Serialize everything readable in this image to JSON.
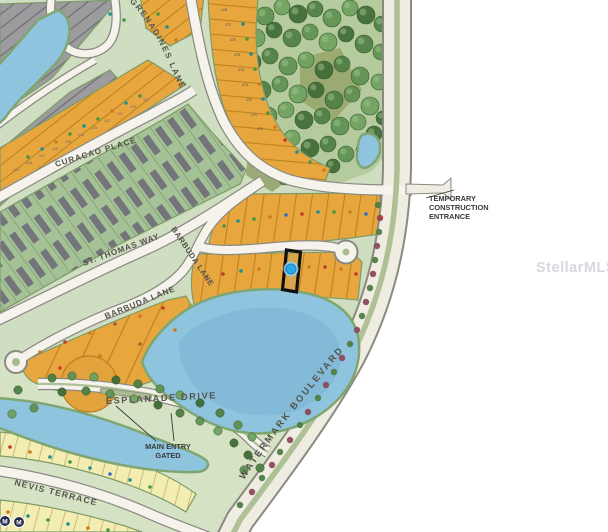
{
  "overlay": {
    "mls_watermark": "StellarMLS"
  },
  "streets": {
    "grenadines": "GRENADINES LANE",
    "curacao": "CURACAO PLACE",
    "st_thomas": "ST. THOMAS WAY",
    "barbuda_upper": "BARBUDA LANE",
    "barbuda_lower": "BARBUDA LANE",
    "esplanade": "ESPLANADE DRIVE",
    "nevis": "NEVIS TERRACE",
    "watermark_blvd": "WATERMARK BOULEVARD"
  },
  "annotations": {
    "temp_entrance": [
      "TEMPORARY",
      "CONSTRUCTION",
      "ENTRANCE"
    ],
    "main_entry": [
      "MAIN ENTRY",
      "GATED"
    ],
    "badge": "M"
  },
  "colors": {
    "base_green": "#cfdec0",
    "forest_green": "#b5cb9e",
    "pond_blue": "#8fc4de",
    "pond_deep": "#79b2d2",
    "road_fill": "#f5f3ec",
    "road_casing": "#8a8a82",
    "blvd_fill": "#efece1",
    "median_green": "#adc096",
    "lot_orange": "#e7a73e",
    "lot_yellow": "#f3edb2",
    "lot_gray": "#9c9c9e",
    "highlight_outline": "#101010",
    "subject_marker": "#2aa7e8",
    "subject_marker_ring": "#8fd0f0"
  },
  "map": {
    "tree_colors": [
      "#3f6b36",
      "#4f7f44",
      "#5f9252",
      "#6fa261"
    ],
    "shrub_colors": {
      "g": "#4e7c42",
      "r": "#8d4a5c"
    },
    "marker_colors": {
      "T": "#1d8f8f",
      "G": "#44973c",
      "O": "#d0791c",
      "R": "#c03a2c",
      "B": "#2f6fc2",
      "N": "#9a6a2a",
      "Y": "#8a7468",
      "K": "#6b6156"
    },
    "trees": [
      [
        230,
        12,
        9
      ],
      [
        248,
        8,
        8
      ],
      [
        265,
        16,
        9
      ],
      [
        282,
        7,
        8
      ],
      [
        298,
        14,
        9
      ],
      [
        315,
        9,
        8
      ],
      [
        332,
        18,
        9
      ],
      [
        350,
        8,
        8
      ],
      [
        366,
        15,
        9
      ],
      [
        382,
        24,
        8
      ],
      [
        238,
        32,
        8
      ],
      [
        256,
        38,
        9
      ],
      [
        274,
        30,
        8
      ],
      [
        292,
        38,
        9
      ],
      [
        310,
        32,
        8
      ],
      [
        328,
        42,
        9
      ],
      [
        346,
        34,
        8
      ],
      [
        364,
        44,
        9
      ],
      [
        381,
        52,
        8
      ],
      [
        234,
        56,
        8
      ],
      [
        252,
        62,
        9
      ],
      [
        270,
        56,
        8
      ],
      [
        288,
        66,
        9
      ],
      [
        306,
        60,
        8
      ],
      [
        324,
        70,
        9
      ],
      [
        342,
        64,
        8
      ],
      [
        360,
        76,
        9
      ],
      [
        379,
        82,
        8
      ],
      [
        244,
        84,
        8
      ],
      [
        262,
        90,
        9
      ],
      [
        280,
        84,
        8
      ],
      [
        298,
        94,
        9
      ],
      [
        316,
        90,
        8
      ],
      [
        334,
        100,
        9
      ],
      [
        352,
        94,
        8
      ],
      [
        370,
        106,
        9
      ],
      [
        383,
        118,
        7
      ],
      [
        250,
        110,
        8
      ],
      [
        268,
        116,
        9
      ],
      [
        286,
        110,
        8
      ],
      [
        304,
        120,
        9
      ],
      [
        322,
        116,
        8
      ],
      [
        340,
        126,
        9
      ],
      [
        358,
        122,
        8
      ],
      [
        374,
        134,
        8
      ],
      [
        256,
        136,
        8
      ],
      [
        274,
        142,
        9
      ],
      [
        292,
        138,
        8
      ],
      [
        310,
        148,
        9
      ],
      [
        328,
        144,
        8
      ],
      [
        346,
        154,
        8
      ],
      [
        363,
        150,
        7
      ],
      [
        262,
        160,
        8
      ],
      [
        280,
        166,
        8
      ],
      [
        298,
        162,
        7
      ],
      [
        316,
        170,
        8
      ],
      [
        333,
        166,
        7
      ],
      [
        285,
        178,
        7
      ]
    ],
    "esplanade_trees": [
      [
        52,
        378
      ],
      [
        72,
        376
      ],
      [
        94,
        377
      ],
      [
        116,
        380
      ],
      [
        138,
        384
      ],
      [
        160,
        389
      ],
      [
        180,
        395
      ],
      [
        200,
        403
      ],
      [
        220,
        413
      ],
      [
        238,
        425
      ],
      [
        252,
        437
      ],
      [
        62,
        392
      ],
      [
        86,
        391
      ],
      [
        110,
        394
      ],
      [
        134,
        399
      ],
      [
        158,
        405
      ],
      [
        180,
        413
      ],
      [
        200,
        421
      ],
      [
        218,
        431
      ],
      [
        234,
        443
      ],
      [
        18,
        390
      ],
      [
        34,
        408
      ],
      [
        12,
        414
      ],
      [
        248,
        455
      ],
      [
        260,
        468
      ],
      [
        244,
        470
      ]
    ],
    "shrubs": [
      [
        240,
        505,
        "g"
      ],
      [
        252,
        492,
        "r"
      ],
      [
        262,
        478,
        "g"
      ],
      [
        272,
        465,
        "r"
      ],
      [
        280,
        452,
        "g"
      ],
      [
        290,
        440,
        "r"
      ],
      [
        300,
        425,
        "g"
      ],
      [
        308,
        412,
        "r"
      ],
      [
        318,
        398,
        "g"
      ],
      [
        326,
        385,
        "r"
      ],
      [
        334,
        372,
        "g"
      ],
      [
        342,
        358,
        "r"
      ],
      [
        350,
        344,
        "g"
      ],
      [
        357,
        330,
        "r"
      ],
      [
        362,
        316,
        "g"
      ],
      [
        366,
        302,
        "r"
      ],
      [
        370,
        288,
        "g"
      ],
      [
        373,
        274,
        "r"
      ],
      [
        375,
        260,
        "g"
      ],
      [
        377,
        246,
        "r"
      ],
      [
        379,
        232,
        "g"
      ],
      [
        380,
        218,
        "r"
      ],
      [
        378,
        205,
        "g"
      ]
    ],
    "lot_markers": [
      {
        "x": 28,
        "y": 157,
        "c": "G"
      },
      {
        "x": 42,
        "y": 149,
        "c": "T"
      },
      {
        "x": 56,
        "y": 142,
        "c": "O"
      },
      {
        "x": 70,
        "y": 134,
        "c": "G"
      },
      {
        "x": 84,
        "y": 126,
        "c": "T"
      },
      {
        "x": 98,
        "y": 119,
        "c": "G"
      },
      {
        "x": 112,
        "y": 111,
        "c": "O"
      },
      {
        "x": 126,
        "y": 103,
        "c": "T"
      },
      {
        "x": 140,
        "y": 96,
        "c": "G"
      },
      {
        "x": 16,
        "y": 171,
        "c": "Y",
        "t": "129"
      },
      {
        "x": 29,
        "y": 164,
        "c": "Y",
        "t": "128"
      },
      {
        "x": 42,
        "y": 157,
        "c": "Y",
        "t": "127"
      },
      {
        "x": 55,
        "y": 150,
        "c": "Y",
        "t": "126"
      },
      {
        "x": 68,
        "y": 143,
        "c": "Y",
        "t": "125"
      },
      {
        "x": 81,
        "y": 136,
        "c": "Y",
        "t": "124"
      },
      {
        "x": 94,
        "y": 129,
        "c": "Y",
        "t": "123"
      },
      {
        "x": 107,
        "y": 122,
        "c": "Y",
        "t": "122"
      },
      {
        "x": 120,
        "y": 115,
        "c": "Y",
        "t": "121"
      },
      {
        "x": 133,
        "y": 108,
        "c": "Y",
        "t": "120"
      },
      {
        "x": 146,
        "y": 101,
        "c": "Y",
        "t": "119"
      },
      {
        "x": 224,
        "y": 11,
        "c": "K",
        "t": "178"
      },
      {
        "x": 228,
        "y": 26,
        "c": "K",
        "t": "177"
      },
      {
        "x": 233,
        "y": 41,
        "c": "K",
        "t": "176"
      },
      {
        "x": 237,
        "y": 56,
        "c": "K",
        "t": "175"
      },
      {
        "x": 241,
        "y": 71,
        "c": "K",
        "t": "174"
      },
      {
        "x": 245,
        "y": 86,
        "c": "K",
        "t": "173"
      },
      {
        "x": 249,
        "y": 101,
        "c": "K",
        "t": "172"
      },
      {
        "x": 254,
        "y": 116,
        "c": "K",
        "t": "171"
      },
      {
        "x": 260,
        "y": 130,
        "c": "K",
        "t": "170"
      },
      {
        "x": 243,
        "y": 24,
        "c": "T"
      },
      {
        "x": 247,
        "y": 39,
        "c": "G"
      },
      {
        "x": 251,
        "y": 54,
        "c": "T"
      },
      {
        "x": 255,
        "y": 69,
        "c": "G"
      },
      {
        "x": 259,
        "y": 84,
        "c": "O"
      },
      {
        "x": 263,
        "y": 99,
        "c": "T"
      },
      {
        "x": 268,
        "y": 113,
        "c": "G"
      },
      {
        "x": 275,
        "y": 127,
        "c": "O"
      },
      {
        "x": 285,
        "y": 140,
        "c": "R"
      },
      {
        "x": 297,
        "y": 152,
        "c": "T"
      },
      {
        "x": 310,
        "y": 162,
        "c": "G"
      },
      {
        "x": 324,
        "y": 170,
        "c": "O"
      },
      {
        "x": 158,
        "y": 14,
        "c": "G"
      },
      {
        "x": 167,
        "y": 27,
        "c": "T"
      },
      {
        "x": 176,
        "y": 40,
        "c": "O"
      },
      {
        "x": 110,
        "y": 14,
        "c": "T"
      },
      {
        "x": 124,
        "y": 20,
        "c": "G"
      },
      {
        "x": 238,
        "y": 221,
        "c": "T"
      },
      {
        "x": 254,
        "y": 219,
        "c": "G"
      },
      {
        "x": 270,
        "y": 217,
        "c": "O"
      },
      {
        "x": 286,
        "y": 215,
        "c": "B"
      },
      {
        "x": 302,
        "y": 214,
        "c": "R"
      },
      {
        "x": 318,
        "y": 212,
        "c": "T"
      },
      {
        "x": 334,
        "y": 212,
        "c": "G"
      },
      {
        "x": 350,
        "y": 212,
        "c": "O"
      },
      {
        "x": 366,
        "y": 214,
        "c": "B"
      },
      {
        "x": 381,
        "y": 218,
        "c": "R"
      },
      {
        "x": 224,
        "y": 226,
        "c": "G"
      },
      {
        "x": 206,
        "y": 277,
        "c": "O"
      },
      {
        "x": 223,
        "y": 274,
        "c": "R"
      },
      {
        "x": 241,
        "y": 271,
        "c": "T"
      },
      {
        "x": 259,
        "y": 269,
        "c": "O"
      },
      {
        "x": 309,
        "y": 267,
        "c": "O"
      },
      {
        "x": 325,
        "y": 267,
        "c": "R"
      },
      {
        "x": 341,
        "y": 269,
        "c": "O"
      },
      {
        "x": 356,
        "y": 274,
        "c": "R"
      },
      {
        "x": 40,
        "y": 352,
        "c": "O"
      },
      {
        "x": 65,
        "y": 342,
        "c": "R"
      },
      {
        "x": 90,
        "y": 333,
        "c": "O"
      },
      {
        "x": 115,
        "y": 324,
        "c": "N"
      },
      {
        "x": 140,
        "y": 316,
        "c": "O"
      },
      {
        "x": 163,
        "y": 308,
        "c": "R"
      },
      {
        "x": 60,
        "y": 368,
        "c": "R"
      },
      {
        "x": 100,
        "y": 356,
        "c": "O"
      },
      {
        "x": 140,
        "y": 344,
        "c": "N"
      },
      {
        "x": 175,
        "y": 330,
        "c": "O"
      },
      {
        "x": 10,
        "y": 447,
        "c": "R"
      },
      {
        "x": 30,
        "y": 452,
        "c": "O"
      },
      {
        "x": 50,
        "y": 457,
        "c": "T"
      },
      {
        "x": 70,
        "y": 462,
        "c": "G"
      },
      {
        "x": 90,
        "y": 468,
        "c": "T"
      },
      {
        "x": 110,
        "y": 474,
        "c": "B"
      },
      {
        "x": 130,
        "y": 480,
        "c": "T"
      },
      {
        "x": 150,
        "y": 487,
        "c": "G"
      },
      {
        "x": 8,
        "y": 512,
        "c": "O"
      },
      {
        "x": 28,
        "y": 516,
        "c": "T"
      },
      {
        "x": 48,
        "y": 520,
        "c": "G"
      },
      {
        "x": 68,
        "y": 524,
        "c": "T"
      },
      {
        "x": 88,
        "y": 528,
        "c": "O"
      },
      {
        "x": 108,
        "y": 530,
        "c": "G"
      }
    ]
  }
}
